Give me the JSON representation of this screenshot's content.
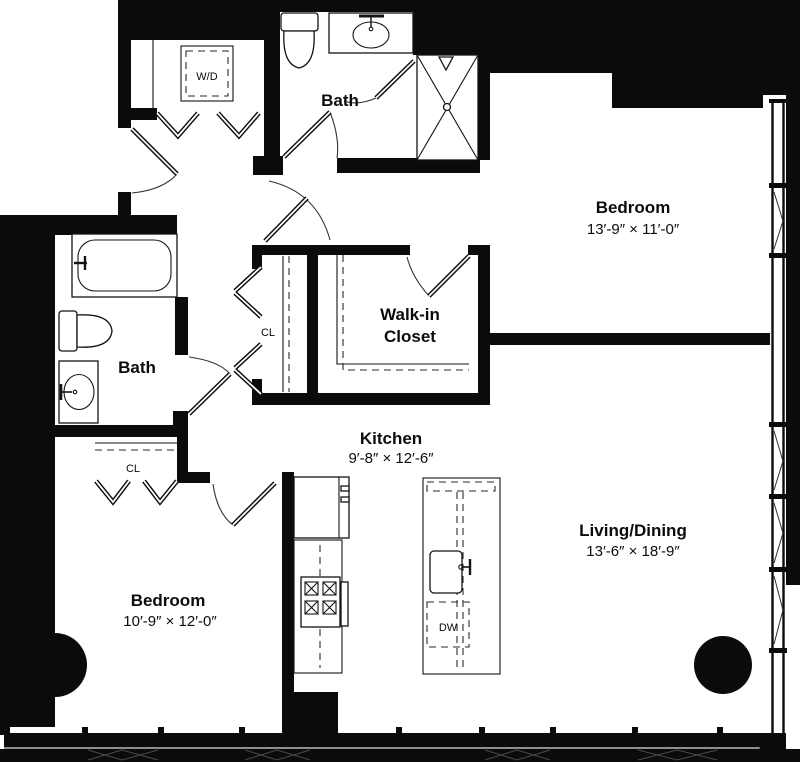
{
  "title": "Two-bedroom apartment floor plan",
  "colors": {
    "ink": "#0b0b0b",
    "background": "#ffffff"
  },
  "rooms": {
    "bath_top": {
      "label": "Bath"
    },
    "bedroom_right": {
      "label": "Bedroom",
      "dims": "13′-9″ × 11′-0″"
    },
    "walk_in_closet": {
      "line1": "Walk-in",
      "line2": "Closet"
    },
    "bath_left": {
      "label": "Bath"
    },
    "kitchen": {
      "label": "Kitchen",
      "dims": "9′-8″ × 12′-6″"
    },
    "living_dining": {
      "label": "Living/Dining",
      "dims": "13′-6″ × 18′-9″"
    },
    "bedroom_left": {
      "label": "Bedroom",
      "dims": "10′-9″ × 12′-0″"
    }
  },
  "fixtures": {
    "washer_dryer": "W/D",
    "hall_closet": "CL",
    "bedroom_closet": "CL",
    "dishwasher": "DW"
  }
}
